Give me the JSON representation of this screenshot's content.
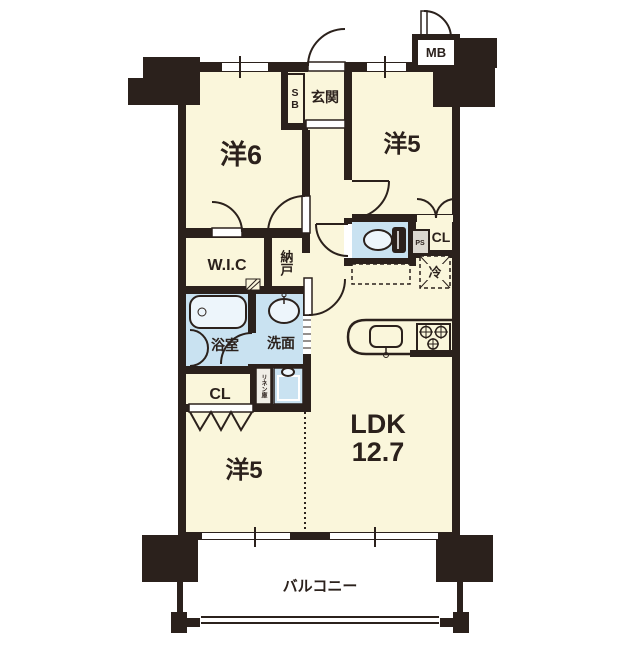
{
  "floorplan": {
    "colors": {
      "wall": "#2B211C",
      "floor": "#FAF6DB",
      "wet": "#C9E2F1",
      "fixture": "#EDF5FB",
      "psfill": "#DCD8D0",
      "linenfill": "#F0EEE6"
    },
    "labels": {
      "room_west6": "洋6",
      "room_west5_upper": "洋5",
      "room_west5_lower": "洋5",
      "ldk": "LDK",
      "ldk_size": "12.7",
      "entrance": "玄関",
      "shoe_box": "SB",
      "meter_box": "MB",
      "walk_in_closet": "W.I.C",
      "storage": "納戸",
      "bathroom": "浴室",
      "washroom": "洗面",
      "closet_upper": "CL",
      "closet_lower": "CL",
      "pipe_space": "PS",
      "refrigerator": "冷",
      "linen": "リネン庫",
      "balcony": "バルコニー"
    }
  }
}
